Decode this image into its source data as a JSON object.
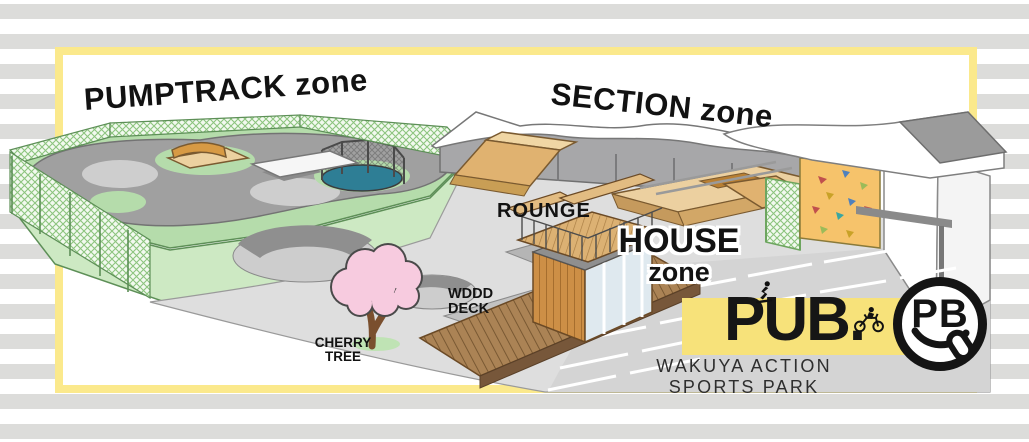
{
  "background": {
    "stripe_color": "#DCDCDA"
  },
  "frame": {
    "border_color": "#FBE98C"
  },
  "map": {
    "zone_labels": {
      "pumptrack": "PUMPTRACK zone",
      "section": "SECTION zone",
      "house_line1": "HOUSE",
      "house_line2": "zone"
    },
    "feature_labels": {
      "rounge": "ROUNGE",
      "wood_deck_line1": "WDDD",
      "wood_deck_line2": "DECK",
      "cherry_tree_line1": "CHERRY",
      "cherry_tree_line2": "TREE"
    },
    "features": [
      "pumptrack",
      "trampoline",
      "mini-ramp",
      "safety-fence",
      "bowls",
      "quarter-pipe",
      "funbox-rails",
      "bank-ramp",
      "climbing-wall",
      "club-house",
      "rooftop-deck",
      "wood-deck",
      "cherry-tree",
      "parking-lot",
      "back-wall"
    ]
  },
  "branding": {
    "logo_text": "PUB.",
    "park_name": "WAKUYA ACTION SPORTS PARK",
    "badge_letters": "PB",
    "banner_color": "#F7E27A",
    "icons": [
      "skateboarder-silhouette",
      "bmx-rider-silhouette",
      "pb-smiley-badge"
    ]
  },
  "colors": {
    "fence_green": "#8CC47E",
    "grass_green": "#B5DCAB",
    "ramp_tan": "#E6C18A",
    "ramp_orange": "#D79A44",
    "wood_brown": "#C9883F",
    "blossom_pink": "#F7CBDF",
    "trampoline_teal": "#2E7E95",
    "wall_gray": "#A7A7A9",
    "ink": "#141414"
  }
}
